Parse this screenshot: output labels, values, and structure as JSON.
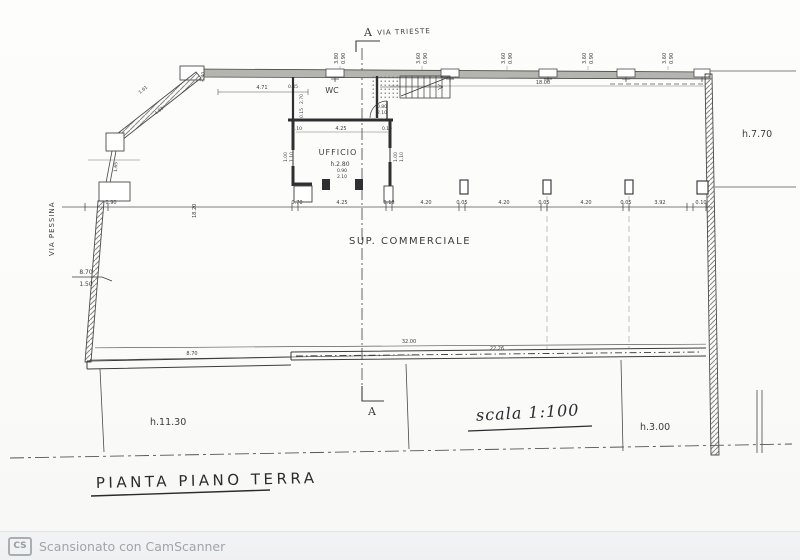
{
  "page": {
    "title": "PIANTA PIANO TERRA",
    "scale_label": "scala 1:100"
  },
  "streets": {
    "top": "VIA TRIESTE",
    "left": "VIA PESSINA"
  },
  "section": {
    "top": "A",
    "bottom": "A"
  },
  "rooms": {
    "wc": "WC",
    "office": "UFFICIO",
    "office_height": "h.2.80",
    "commercial": "SUP. COMMERCIALE"
  },
  "heights": {
    "right": "h.7.70",
    "left_area": "h.11.30",
    "right_area": "h.3.00"
  },
  "window_dims": [
    {
      "a": "3.80",
      "b": "0.90"
    },
    {
      "a": "3.60",
      "b": "0.90"
    },
    {
      "a": "3.60",
      "b": "0.90"
    },
    {
      "a": "3.60",
      "b": "0.90"
    },
    {
      "a": "3.60",
      "b": "0.90"
    }
  ],
  "diag_dims": {
    "d1": "1.61",
    "d2": "4.83",
    "d3": "2.40"
  },
  "top_dims": {
    "span_left": "4.71",
    "small": "0.45",
    "span_right": "18.00",
    "wc_v1": "2.70",
    "wc_v2": "0.15"
  },
  "stair_door": {
    "w": "0.80",
    "h": "2.10"
  },
  "office_dims": {
    "t1": "0.10",
    "t2": "4.25",
    "t3": "0.10",
    "side_a": "1.00",
    "side_b": "1.10",
    "door_w": "0.90",
    "door_h": "2.10"
  },
  "left_dims": {
    "v1": "1.65",
    "v2": "0.90",
    "frac_top": "8.70",
    "frac_bot": "1.50"
  },
  "chain": [
    "0.90",
    "18.20",
    "0.70",
    "4.25",
    "0.10",
    "4.20",
    "0.05",
    "4.20",
    "0.05",
    "4.20",
    "0.05",
    "3.92",
    "0.10"
  ],
  "bottom_dims": {
    "front": "8.70",
    "total": "32.00",
    "inner": "22.26"
  },
  "footer": {
    "badge": "CS",
    "text": "Scansionato con CamScanner"
  }
}
